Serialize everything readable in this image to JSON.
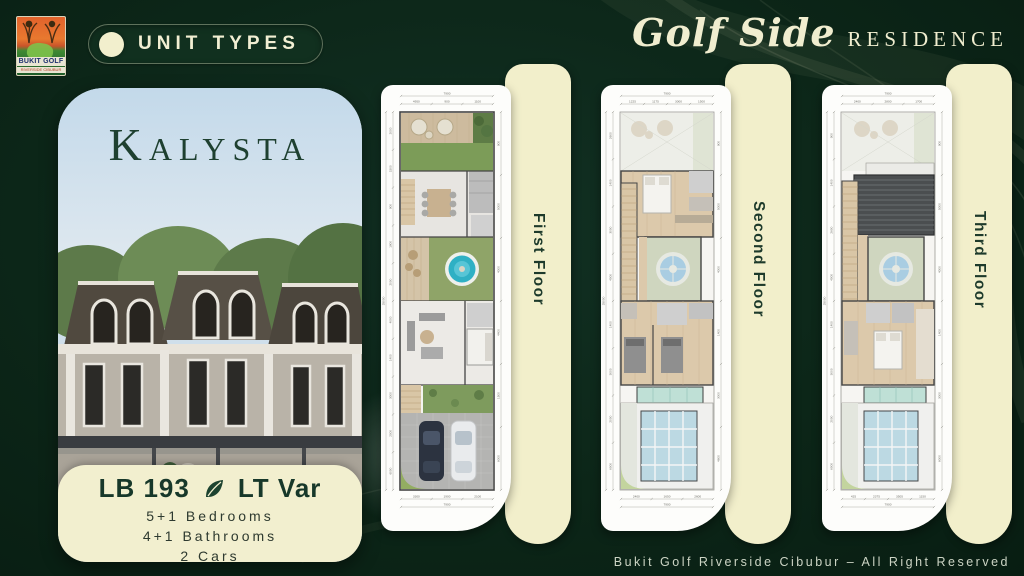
{
  "page": {
    "background": "#0c2618",
    "accent_cream": "#f2efcd",
    "accent_green": "#1d3a2b"
  },
  "header": {
    "logo": {
      "title": "BUKIT GOLF",
      "sub": "RIVERSIDE CIBUBUR"
    },
    "badge": {
      "label": "UNIT TYPES"
    },
    "brand": {
      "script": "Golf Side",
      "serif": "RESIDENCE"
    }
  },
  "unit_card": {
    "name": "Kalysta",
    "lb": "LB 193",
    "lt": "LT Var",
    "leaf_icon": "leaf-icon",
    "specs": [
      "5+1 Bedrooms",
      "4+1 Bathrooms",
      "2 Cars"
    ]
  },
  "floors": [
    {
      "label": "First Floor",
      "dims": {
        "top": [
          "4950",
          "900",
          "1100"
        ],
        "top_total": "7900",
        "bottom": [
          "3300",
          "1900",
          "2100"
        ],
        "bottom_total": "7900",
        "left": [
          "2000",
          "1500",
          "900",
          "1800",
          "2000",
          "4000",
          "1400",
          "3000",
          "2000",
          "6000"
        ],
        "left_total": "25000",
        "right": [
          "900",
          "5000",
          "4000",
          "4400",
          "1500",
          "6000"
        ]
      }
    },
    {
      "label": "Second Floor",
      "dims": {
        "top": [
          "1225",
          "1175",
          "3000",
          "1500"
        ],
        "top_total": "7900",
        "bottom": [
          "2400",
          "1650",
          "2600"
        ],
        "bottom_total": "7900",
        "left": [
          "2600",
          "1400",
          "3000",
          "4000",
          "1400",
          "3000",
          "2000",
          "6000"
        ],
        "left_total": "25000",
        "right": [
          "900",
          "5000",
          "4000",
          "1400",
          "3000",
          "4600"
        ]
      }
    },
    {
      "label": "Third Floor",
      "dims": {
        "top": [
          "2400",
          "2800",
          "1700"
        ],
        "top_total": "7900",
        "bottom": [
          "425",
          "2375",
          "3505",
          "1150"
        ],
        "bottom_total": "7900",
        "left": [
          "900",
          "1400",
          "2600",
          "4000",
          "1400",
          "3000",
          "2000",
          "6000"
        ],
        "left_total": "25000",
        "right": [
          "900",
          "5000",
          "4000",
          "1400",
          "3000",
          "6000"
        ]
      }
    }
  ],
  "footer": {
    "copyright": "Bukit Golf Riverside Cibubur – All Right Reserved"
  }
}
